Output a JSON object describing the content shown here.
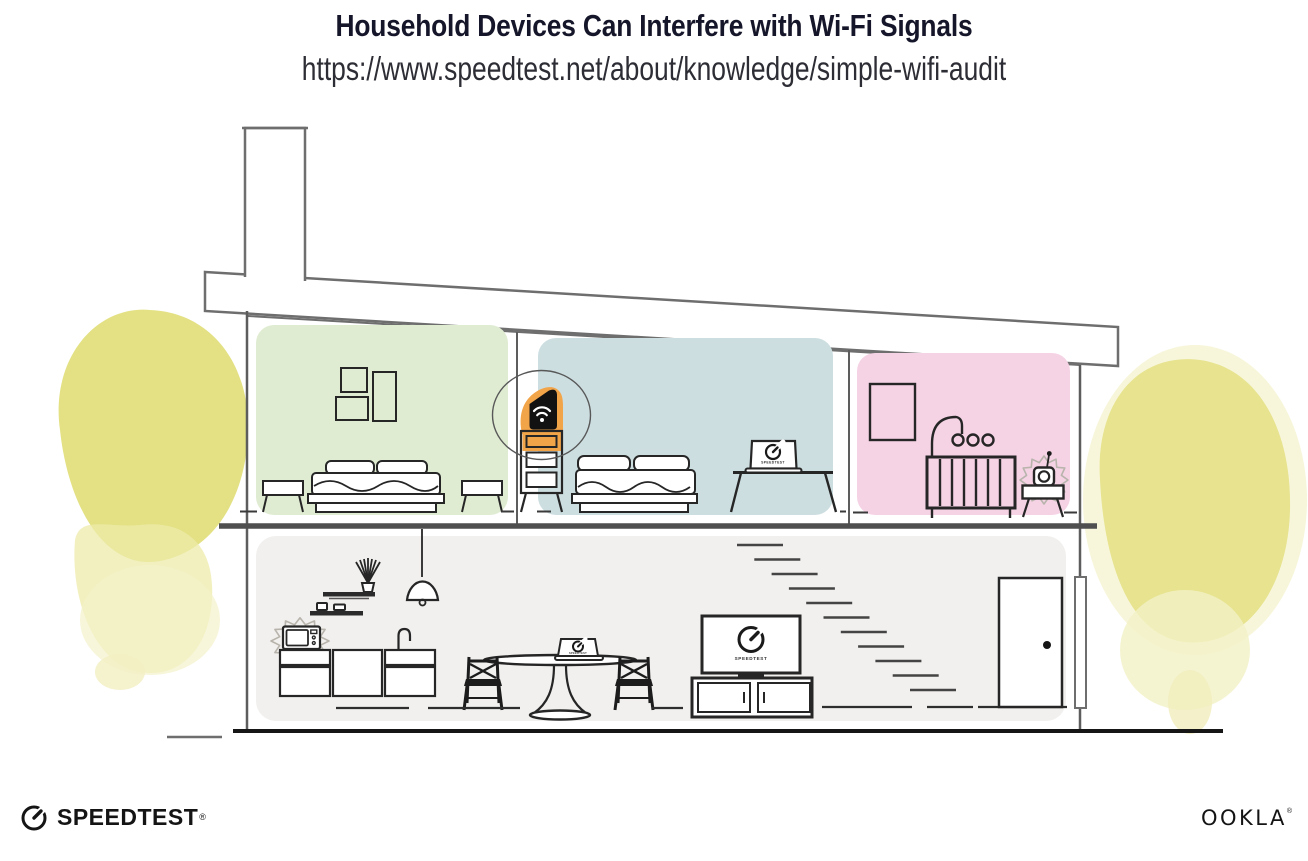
{
  "header": {
    "title": "Household Devices Can Interfere with Wi-Fi Signals",
    "subtitle_url": "https://www.speedtest.net/about/knowledge/simple-wifi-audit"
  },
  "branding": {
    "speedtest_wordmark": "SPEEDTEST",
    "speedtest_registered_mark": "®",
    "ookla_wordmark": "OOKLA",
    "ookla_registered_mark": "®"
  },
  "illustration": {
    "device_screens": {
      "tv_logo_label": "SPEEDTEST",
      "bedroom_laptop_logo_label": "SPEEDTEST",
      "dining_laptop_logo_label": "SPEEDTEST"
    },
    "icons": {
      "router": "wifi-icon",
      "screens": "speedtest-gauge-icon",
      "interference": "interference-burst-icon"
    },
    "colors": {
      "bedroom_left_bg": "#dfecd2",
      "bedroom_middle_bg": "#cddee1",
      "nursery_bg": "#f5d3e5",
      "downstairs_bg": "#f1f0ee",
      "router_highlight": "#f2a449",
      "foliage_main": "#e2df7d",
      "foliage_light": "#efecab",
      "structure_line": "#6e6e6e",
      "ink": "#262626"
    }
  }
}
